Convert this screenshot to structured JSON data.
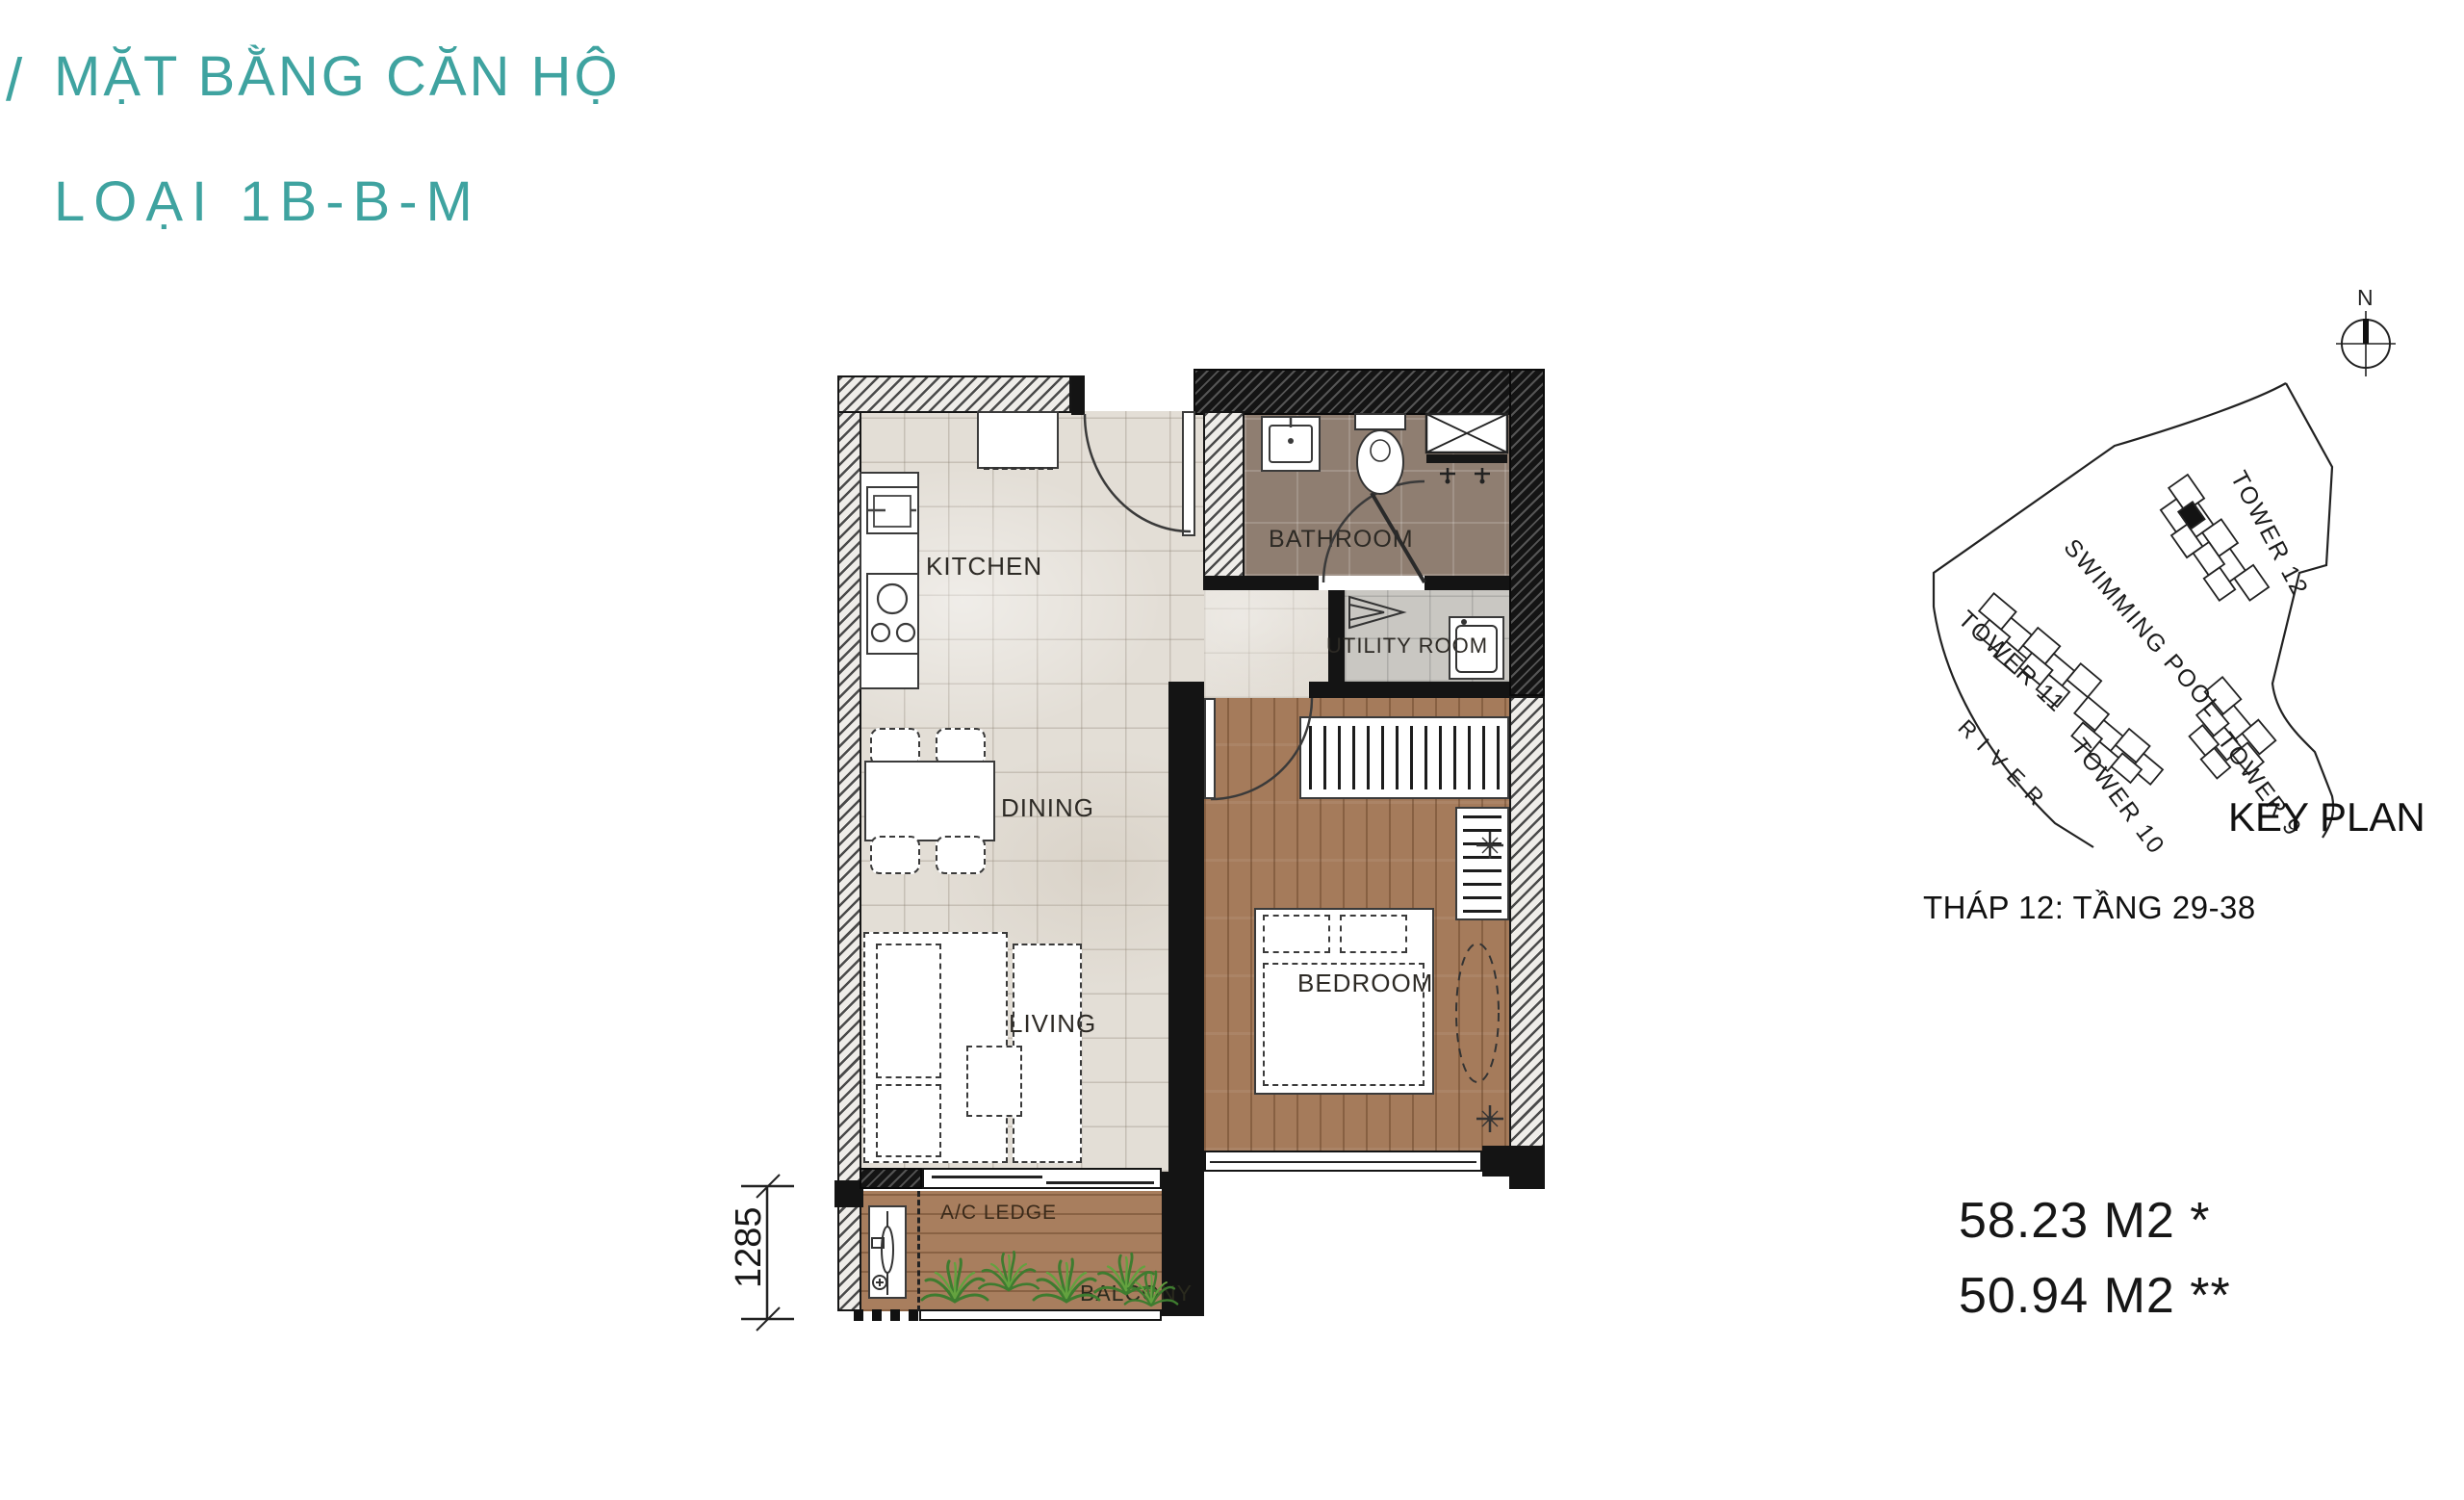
{
  "colors": {
    "accent_teal": "#3fa3a0",
    "wall": "#141414",
    "tile_floor": "#e3ded6",
    "wood_floor": "#a57b5b",
    "bath_tile": "#8f7e71",
    "utility_tile": "#c9c7c2",
    "plant_green": "#3e7c2f"
  },
  "title": {
    "slash": "/",
    "line1": "MẶT BẰNG CĂN HỘ",
    "line2": "LOẠI 1B-B-M"
  },
  "floor_plan": {
    "rooms": {
      "kitchen": "KITCHEN",
      "bathroom": "BATHROOM",
      "utility": "UTILITY ROOM",
      "dining": "DINING",
      "living": "LIVING",
      "bedroom": "BEDROOM",
      "ac_ledge": "A/C LEDGE",
      "balcony": "BALCONY"
    },
    "dimension_label": "1285"
  },
  "key_plan": {
    "north_label": "N",
    "towers": {
      "t12": "TOWER 12",
      "t11": "TOWER 11",
      "t10": "TOWER 10",
      "t9": "TOWER 9"
    },
    "swimming_pool": "SWIMMING POOL",
    "river": "RIVER",
    "title": "KEY PLAN",
    "caption": "THÁP 12: TẦNG 29-38"
  },
  "areas": {
    "line1": "58.23 M2 *",
    "line2": "50.94 M2 **"
  }
}
